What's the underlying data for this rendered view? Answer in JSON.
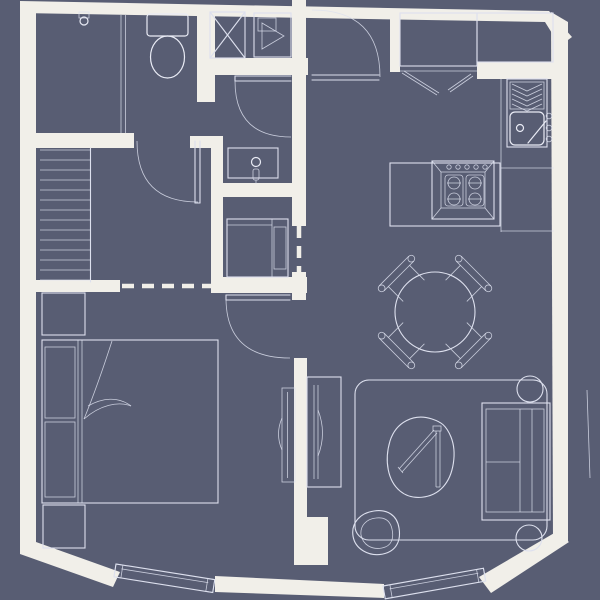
{
  "meta": {
    "type": "architectural floor plan",
    "style": "thin white line drawing on slate-blue ground, photo of printed plan, no text labels",
    "text_labels": []
  },
  "palette": {
    "background": "#585d73",
    "walls": "#f1efe9",
    "lines": "#dde0ee",
    "lines_bright": "#e9ebf5"
  },
  "rooms": [
    {
      "name": "bathroom-wc",
      "location": "top-left",
      "fixtures": [
        "wall fixture with small circle",
        "toilet with tank",
        "shower stall marked with X",
        "appliance cabinet with triangle symbol"
      ]
    },
    {
      "name": "entry-hall",
      "location": "top-center",
      "fixtures": [
        "front door quarter-swing into hall"
      ]
    },
    {
      "name": "kitchen",
      "location": "top-right",
      "fixtures": [
        "tall cabinet / fridge box with double front line",
        "second counter cabinet",
        "bifold closet doors",
        "wall counter with division lines",
        "sink with herringbone drainboard, drain, faucet and 3 wall knobs",
        "island peninsula with 4-burner stove and 5 knobs"
      ]
    },
    {
      "name": "stair-hall",
      "location": "middle-left",
      "fixtures": [
        "staircase with 14 treads",
        "swing door to wc",
        "swing door to hall",
        "vanity sink cabinet with drain and faucet",
        "washer/appliance closet with door panel",
        "dashed ceiling openings"
      ]
    },
    {
      "name": "bedroom",
      "location": "bottom-left",
      "fixtures": [
        "nightstand upper",
        "double bed with two pillows and folded-back sheet",
        "nightstand lower",
        "wall panel / tv on party wall",
        "tilted window in bottom wall",
        "swing door from living room"
      ]
    },
    {
      "name": "living-dining",
      "location": "right",
      "fixtures": [
        "round dining table",
        "four diagonal dining chairs with round feet",
        "area rug with rounded corners",
        "lounge chair with two fold bars",
        "floor pouf (organic blob)",
        "two-seat sofa against right wall",
        "two round side tables at sofa ends",
        "tv console with curved screen on party wall",
        "tilted window in bottom wall",
        "terrace edge line outside right wall"
      ]
    }
  ],
  "doors": [
    {
      "name": "front-door",
      "hinge": "top of entry hall",
      "swing": "quarter arc into hall"
    },
    {
      "name": "wc-door",
      "hinge": "stair-hall side",
      "swing": "quarter arc down-left"
    },
    {
      "name": "bath-inner-door",
      "hinge": "right",
      "swing": "quarter arc down-left"
    },
    {
      "name": "bedroom-door",
      "hinge": "party wall",
      "swing": "quarter arc into bedroom"
    },
    {
      "name": "kitchen-closet-doors",
      "type": "two angled leaves"
    }
  ],
  "windows": [
    {
      "name": "bedroom-window",
      "wall": "bottom-left, tilted"
    },
    {
      "name": "living-window",
      "wall": "bottom-right, tilted"
    }
  ]
}
